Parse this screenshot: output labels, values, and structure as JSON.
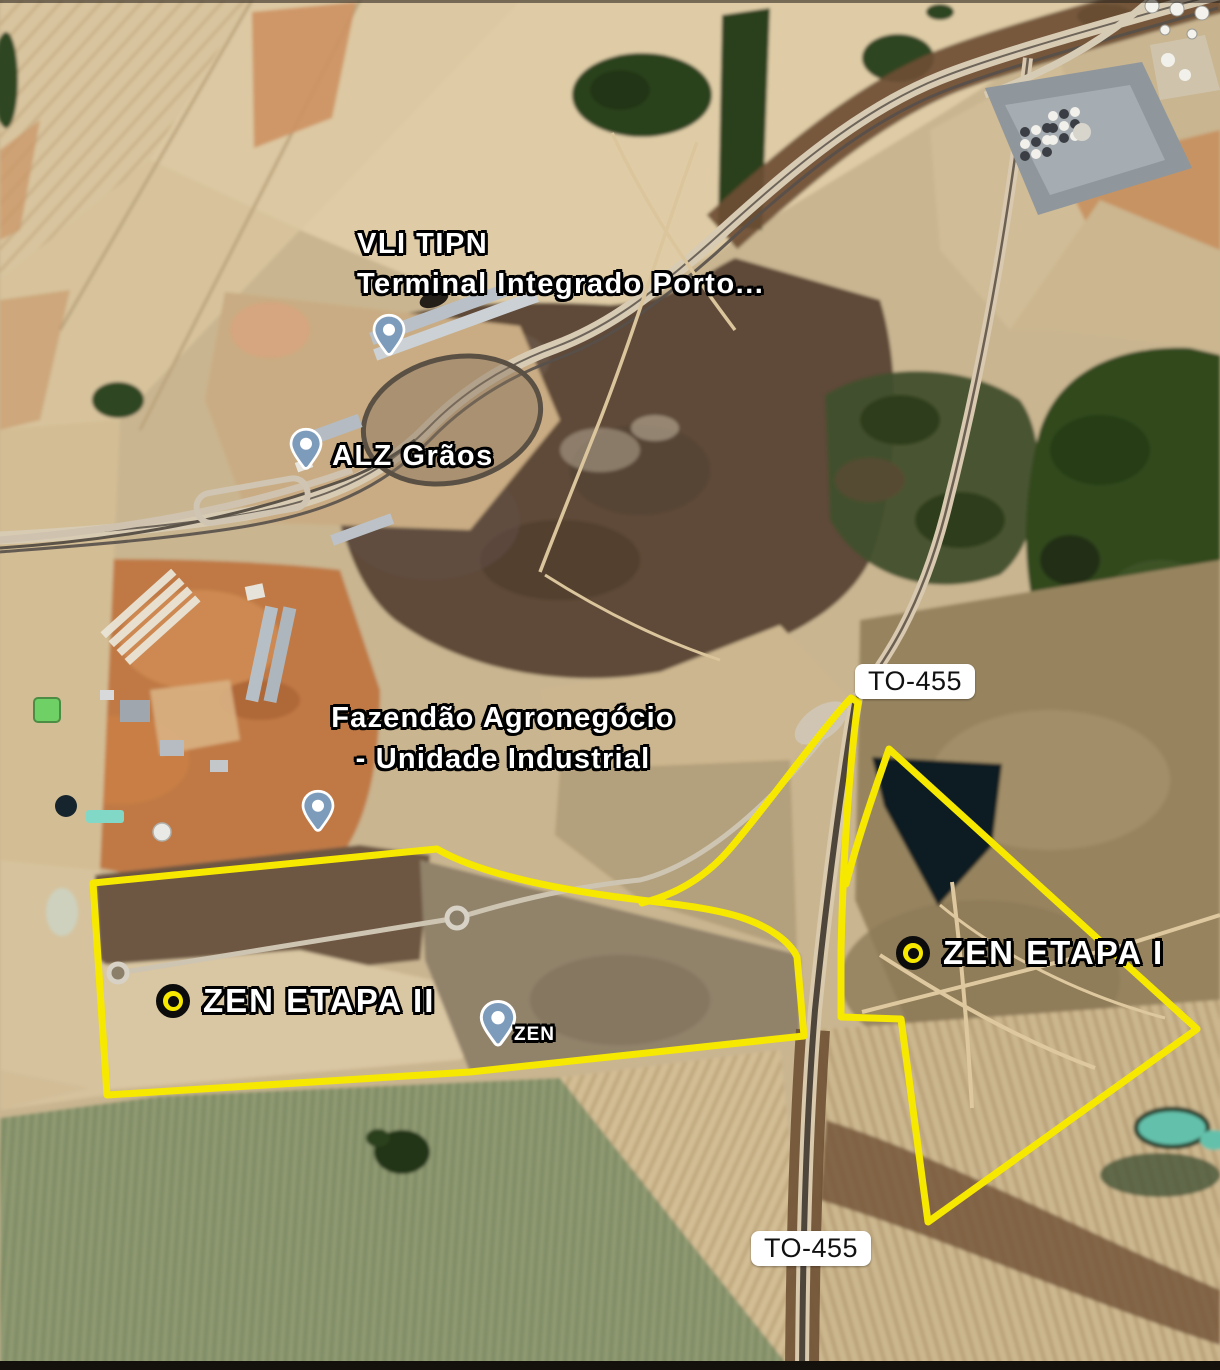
{
  "map": {
    "type": "satellite-imagery-with-annotations",
    "labels": {
      "vli_terminal": {
        "line1": "VLI TIPN",
        "line2": "Terminal Integrado Porto..."
      },
      "alz_graos": "ALZ Grãos",
      "fazendao": {
        "line1": "Fazendão Agronegócio",
        "line2": "- Unidade Industrial"
      },
      "zen_etapa_i": "ZEN ETAPA I",
      "zen_etapa_ii": "ZEN ETAPA II",
      "zen": "ZEN",
      "to455_north": "TO-455",
      "to455_south": "TO-455"
    },
    "markers": [
      {
        "name": "vli-terminal-pin",
        "kind": "place-pin"
      },
      {
        "name": "alz-graos-pin",
        "kind": "place-pin"
      },
      {
        "name": "fazendao-pin",
        "kind": "place-pin"
      },
      {
        "name": "zen-pin",
        "kind": "place-pin"
      },
      {
        "name": "zen-etapa-i-marker",
        "kind": "bullseye"
      },
      {
        "name": "zen-etapa-ii-marker",
        "kind": "bullseye"
      }
    ],
    "overlays": {
      "zen_etapa_ii_boundary": "M 93,883 L 437,849 C 475,871 540,886 610,896 C 660,903 705,906 740,917 C 768,926 790,941 797,957 L 804,1036 L 470,1072 L 107,1095 Z",
      "zen_etapa_i_boundary": "M 642,903 C 678,894 706,876 728,851 C 760,815 824,726 851,698 L 858,702 C 849,768 843,860 841,950 L 841,1017 L 901,1019 L 928,1222 L 1197,1029 L 889,749 C 874,792 858,838 846,884"
    },
    "colors": {
      "boundary_yellow": "#f7e800",
      "pin_blue": "#7d9bbb",
      "bullseye_black": "#0c0c0c",
      "bullseye_yellow": "#f7e800",
      "road_badge_bg": "#ffffff",
      "road_badge_text": "#111111",
      "label_text": "#ffffff",
      "label_outline": "#000000"
    }
  }
}
